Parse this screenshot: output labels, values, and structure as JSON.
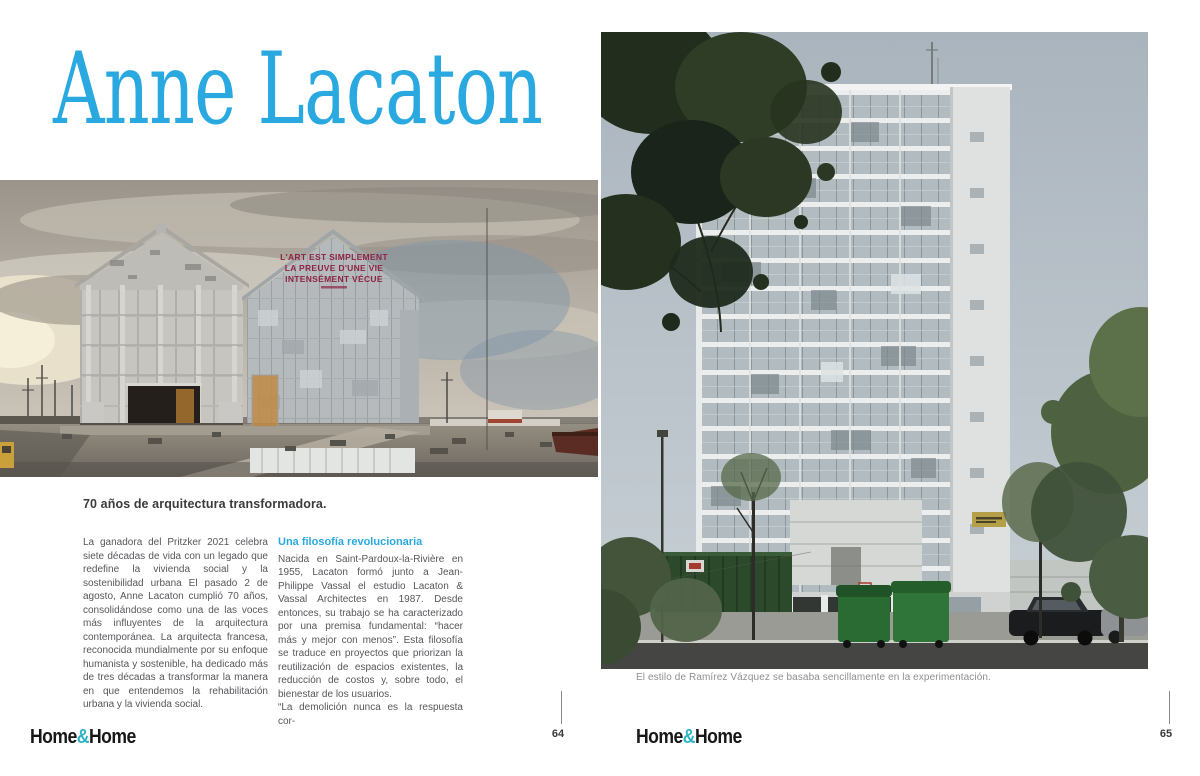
{
  "colors": {
    "accent_blue": "#2aa9e0",
    "logo_teal": "#2eb3c6",
    "building_red": "#8e2442"
  },
  "left_page": {
    "title": "Anne Lacaton",
    "section_heading": "70 años de arquitectura transformadora.",
    "column1": "La ganadora del Pritzker 2021 celebra siete décadas de vida con un legado que redefine la vivienda social y la sostenibilidad urbana El pasado 2 de agosto, Anne Lacaton cumplió 70 años, consolidándose como una de las voces más influyentes de la arquitectura contemporánea. La arquitecta francesa, reconocida mundialmente por su enfoque humanista y sostenible, ha dedicado más de tres décadas a transformar la manera en que entendemos la rehabilitación urbana y la vivienda social.",
    "column2": {
      "heading": "Una filosofía revolucionaria",
      "paragraph1": "Nacida en Saint-Pardoux-la-Rivière en 1955, Lacaton formó junto a Jean-Philippe Vassal el estudio Lacaton & Vassal Architectes en 1987. Desde entonces, su trabajo se ha caracterizado por una premisa fundamental: “hacer más y mejor con menos”. Esta filosofía se traduce en proyectos que priorizan la reutilización de espacios existentes, la reducción de costos y, sobre todo, el bienestar de los usuarios.",
      "paragraph2": "“La demolición nunca es la respuesta cor-"
    },
    "photo": {
      "building_text_line1": "L'ART EST SIMPLEMENT",
      "building_text_line2": "LA PREUVE D'UNE VIE",
      "building_text_line3": "INTENSÉMENT VÉCUE"
    },
    "footer": {
      "logo_home1": "Home",
      "logo_amp": "&",
      "logo_home2": "Home",
      "page_number": "64"
    }
  },
  "right_page": {
    "caption": "El estilo de Ramírez Vázquez se basaba sencillamente en la experimentación.",
    "footer": {
      "logo_home1": "Home",
      "logo_amp": "&",
      "logo_home2": "Home",
      "page_number": "65"
    }
  }
}
